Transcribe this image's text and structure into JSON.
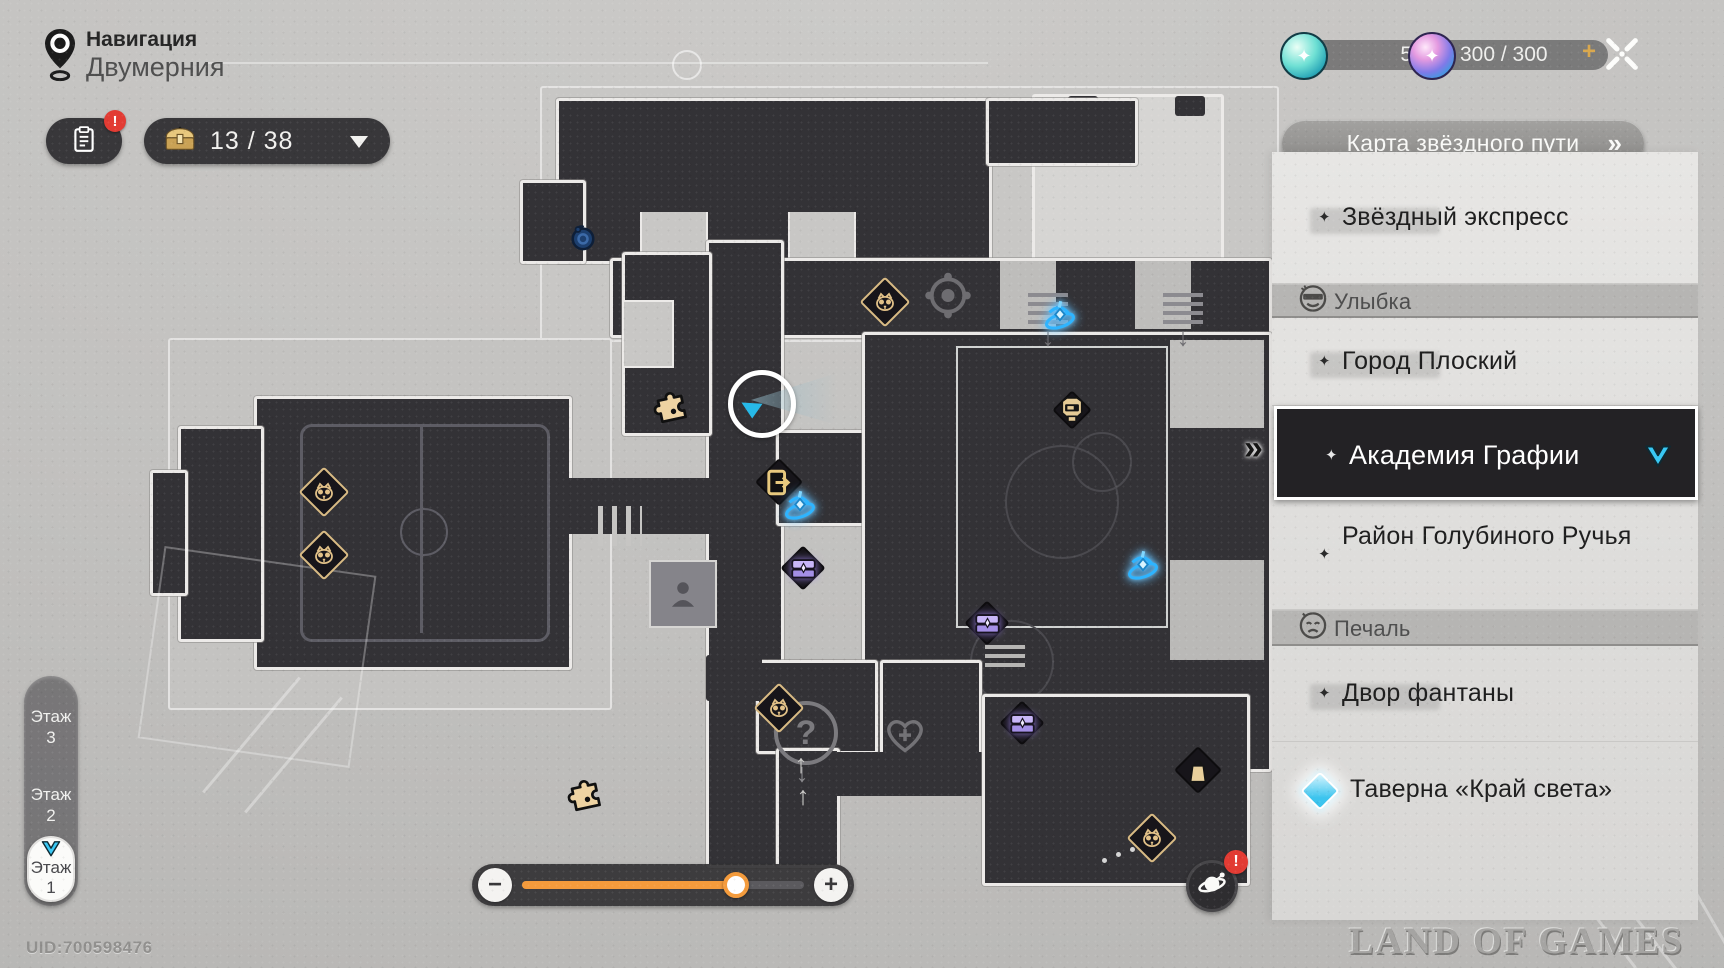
{
  "header": {
    "nav_title": "Навигация",
    "nav_subtitle": "Двумерния"
  },
  "toolbar": {
    "chest_counter": "13 / 38"
  },
  "currencies": {
    "stellar": {
      "value": "5"
    },
    "fuel": {
      "value": "300 / 300",
      "plus_label": "+"
    }
  },
  "map_panel_button": {
    "label": "Карта звёздного пути",
    "chevrons": "»"
  },
  "sidebar": {
    "items": [
      {
        "id": "star-express",
        "kind": "location",
        "label": "Звёздный экспресс",
        "silhouette": true
      },
      {
        "id": "smile-header",
        "kind": "header",
        "label": "Улыбка",
        "icon": "smile-face"
      },
      {
        "id": "flat-city",
        "kind": "location",
        "label": "Город Плоский",
        "silhouette": true
      },
      {
        "id": "grafio-academy",
        "kind": "selected",
        "label": "Академия Графии",
        "cursor": "»"
      },
      {
        "id": "pigeon-creek",
        "kind": "location",
        "label": "Район Голубиного Ручья",
        "silhouette": false
      },
      {
        "id": "sadness-header",
        "kind": "header",
        "label": "Печаль",
        "icon": "sad-face"
      },
      {
        "id": "fountain-yard",
        "kind": "location",
        "label": "Двор фантаны",
        "silhouette": true
      },
      {
        "id": "tavern-edge",
        "kind": "teleport",
        "label": "Таверна «Край света»"
      }
    ]
  },
  "floors": {
    "items": [
      "Этаж 3",
      "Этаж 2",
      "Этаж 1"
    ],
    "selected_index": 2
  },
  "zoom_slider": {
    "minus": "−",
    "plus": "+",
    "percent": 75
  },
  "footer": {
    "uid": "UID:700598476",
    "watermark": "LAND OF GAMES"
  },
  "map": {
    "markers": [
      {
        "type": "blue-creature",
        "x": 583,
        "y": 237
      },
      {
        "type": "trotter-chest",
        "x": 885,
        "y": 302
      },
      {
        "type": "space-anchor",
        "x": 1060,
        "y": 318
      },
      {
        "type": "robot-head",
        "x": 1072,
        "y": 410
      },
      {
        "type": "puzzle-piece",
        "x": 671,
        "y": 405
      },
      {
        "type": "exit-door",
        "x": 779,
        "y": 482
      },
      {
        "type": "space-anchor",
        "x": 800,
        "y": 508
      },
      {
        "type": "trotter-chest",
        "x": 324,
        "y": 492
      },
      {
        "type": "trotter-chest",
        "x": 324,
        "y": 555
      },
      {
        "type": "purple-chest",
        "x": 803,
        "y": 568
      },
      {
        "type": "space-anchor",
        "x": 1143,
        "y": 568
      },
      {
        "type": "purple-chest",
        "x": 987,
        "y": 623
      },
      {
        "type": "trotter-chest",
        "x": 779,
        "y": 708
      },
      {
        "type": "purple-chest",
        "x": 1022,
        "y": 723
      },
      {
        "type": "shop-bag",
        "x": 1198,
        "y": 770
      },
      {
        "type": "trotter-chest",
        "x": 1152,
        "y": 838
      },
      {
        "type": "puzzle-piece",
        "x": 585,
        "y": 793
      },
      {
        "type": "player",
        "x": 757,
        "y": 399
      }
    ],
    "decals": [
      {
        "type": "compass",
        "x": 948,
        "y": 298
      },
      {
        "type": "stairs-down",
        "x": 1028,
        "y": 293
      },
      {
        "type": "stairs-down",
        "x": 1163,
        "y": 293
      },
      {
        "type": "stairs",
        "x": 985,
        "y": 645
      },
      {
        "type": "hatch",
        "x": 598,
        "y": 506
      },
      {
        "type": "person-room",
        "x": 683,
        "y": 594
      },
      {
        "type": "question",
        "x": 806,
        "y": 733
      },
      {
        "type": "heart-cross",
        "x": 905,
        "y": 737
      },
      {
        "type": "up-arrow",
        "x": 801,
        "y": 764
      },
      {
        "type": "up-arrow",
        "x": 803,
        "y": 796
      },
      {
        "type": "dots",
        "x": 1102,
        "y": 852
      }
    ]
  }
}
